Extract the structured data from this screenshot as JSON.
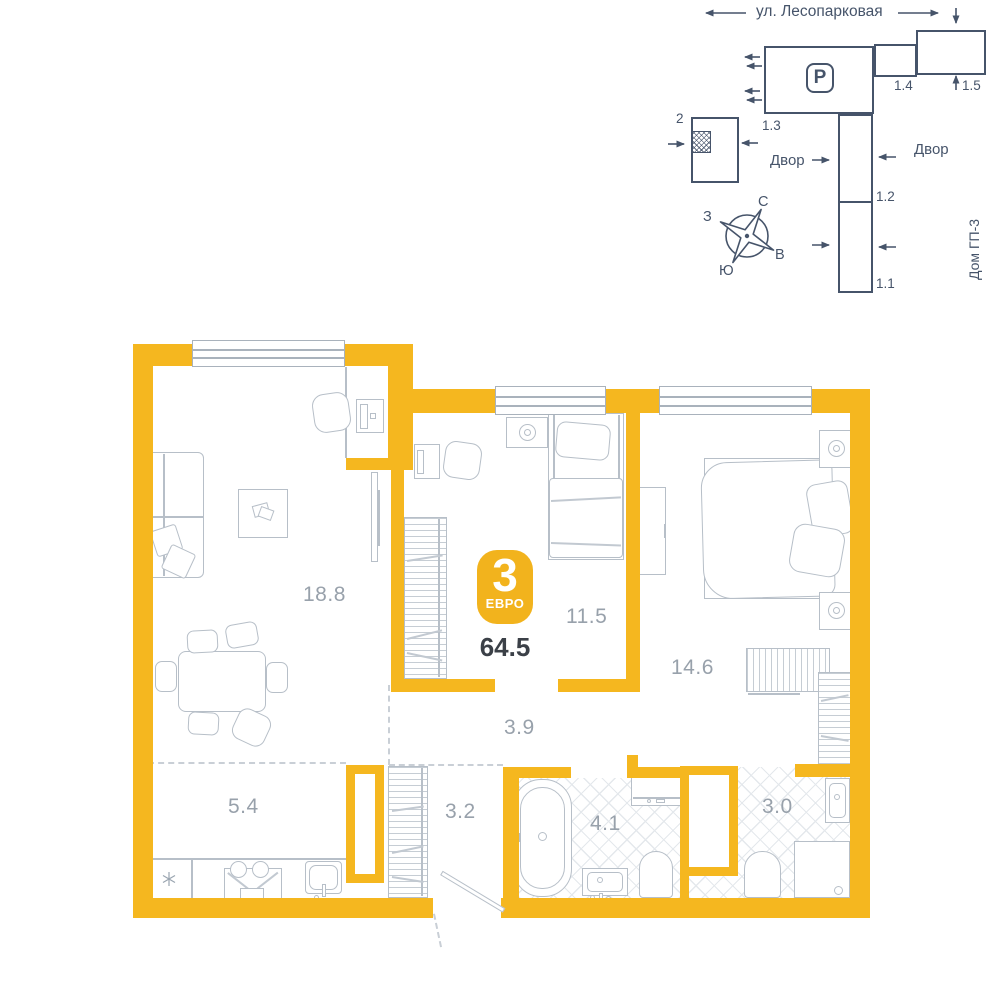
{
  "colors": {
    "wall": "#f5b71f",
    "badge_bg": "#f2b31d",
    "minimap_line": "#46546a",
    "furniture_line": "#b7bfc8",
    "room_label": "#98a1ab",
    "area_value": "#3b4047"
  },
  "minimap": {
    "street": "ул. Лесопарковая",
    "courtyard_left": "Двор",
    "courtyard_right": "Двор",
    "house": "Дом ГП-3",
    "parking": "P",
    "sections": {
      "s2": "2",
      "s11": "1.1",
      "s12": "1.2",
      "s13": "1.3",
      "s14": "1.4",
      "s15": "1.5"
    },
    "compass": {
      "north": "С",
      "south": "Ю",
      "west": "З",
      "east": "В"
    }
  },
  "plan": {
    "badge": {
      "rooms": "3",
      "type": "ЕВРО",
      "area": "64.5"
    },
    "rooms": {
      "living": {
        "label": "18.8"
      },
      "bedroom1": {
        "label": "11.5"
      },
      "bedroom2": {
        "label": "14.6"
      },
      "corridor": {
        "label": "3.9"
      },
      "kitchen": {
        "label": "5.4"
      },
      "hall": {
        "label": "3.2"
      },
      "bath": {
        "label": "4.1"
      },
      "wc": {
        "label": "3.0"
      }
    }
  }
}
